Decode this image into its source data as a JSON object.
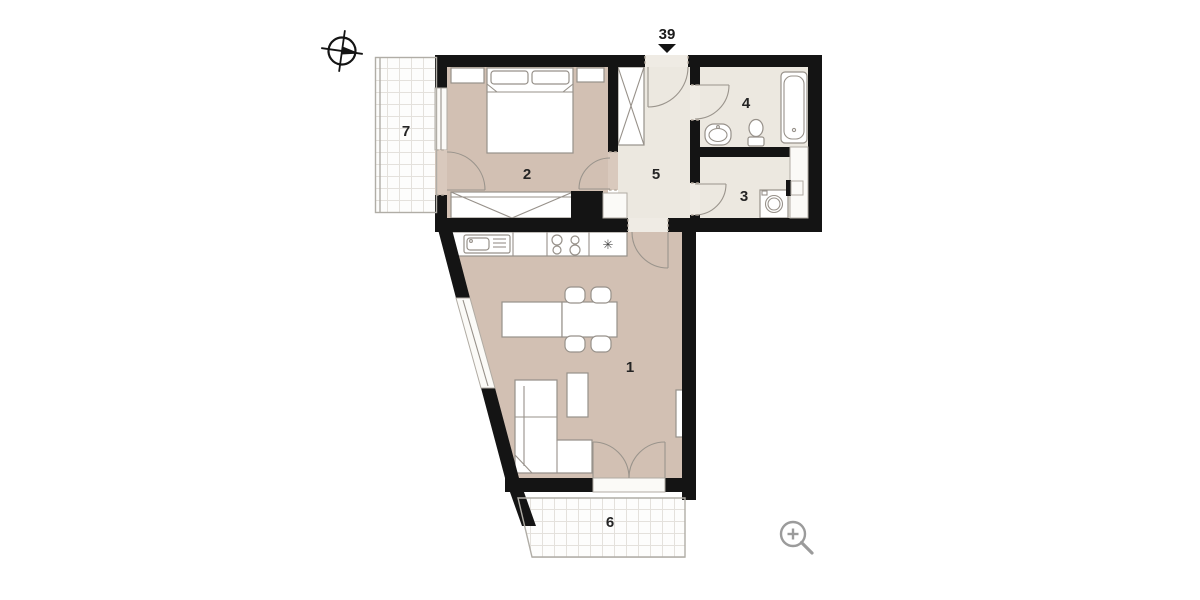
{
  "unit": {
    "number": "39"
  },
  "rooms": {
    "living": {
      "number": "1"
    },
    "bedroom": {
      "number": "2"
    },
    "utility": {
      "number": "3"
    },
    "bathroom": {
      "number": "4"
    },
    "hallway": {
      "number": "5"
    },
    "balcony_south": {
      "number": "6"
    },
    "balcony_west": {
      "number": "7"
    }
  },
  "symbols": {
    "refrigerator": "✳"
  },
  "icons": {
    "compass": "compass-icon",
    "entrance_arrow": "entrance-arrow-icon",
    "zoom_in": "zoom-in-icon"
  },
  "colors": {
    "wall": "#141414",
    "floor_main": "#d2c0b3",
    "floor_service": "#ece8e0",
    "furniture_outline": "#97918a",
    "balcony_tile_line": "#e4e1dc",
    "icon_gray": "#9b9b9b",
    "label": "#242424"
  }
}
